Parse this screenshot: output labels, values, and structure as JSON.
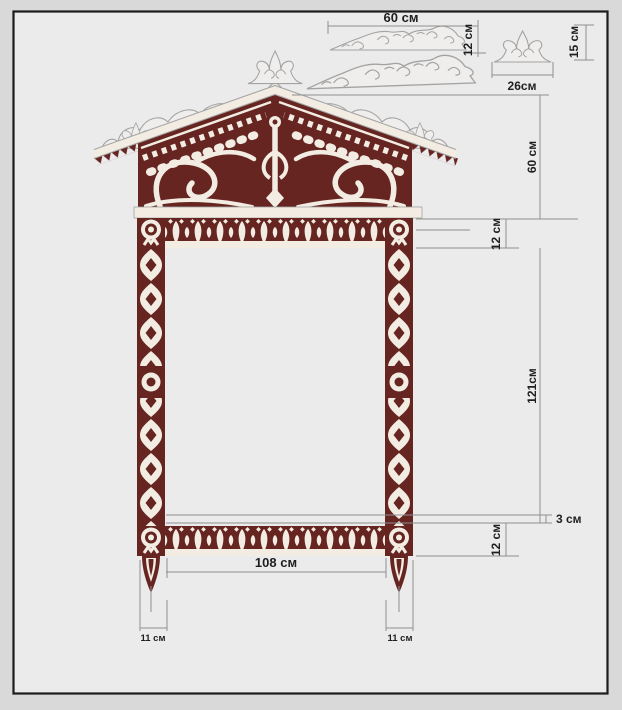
{
  "palette": {
    "maroon": "#662521",
    "cream": "#f2ece2",
    "outline": "#a3a3a3",
    "white_part": "#efeeec",
    "dim_line": "#8f8f8f",
    "text": "#1f1f1f",
    "panel": "#ebebeb",
    "margin": "#d9d9d9",
    "border": "#1c1c1c"
  },
  "drawing": {
    "subject": "carved-window-frame-blueprint",
    "units": "см"
  },
  "dims": {
    "detail_width": "60 см",
    "detail_height": "12 см",
    "finial_height": "15 см",
    "finial_width": "26см",
    "pediment_height": "60 см",
    "frieze_height": "12 см",
    "column_length": "121см",
    "sill_offset": "3 см",
    "sill_height": "12 см",
    "opening_width": "108 см",
    "column_width_left": "11 см",
    "column_width_right": "11 см"
  }
}
